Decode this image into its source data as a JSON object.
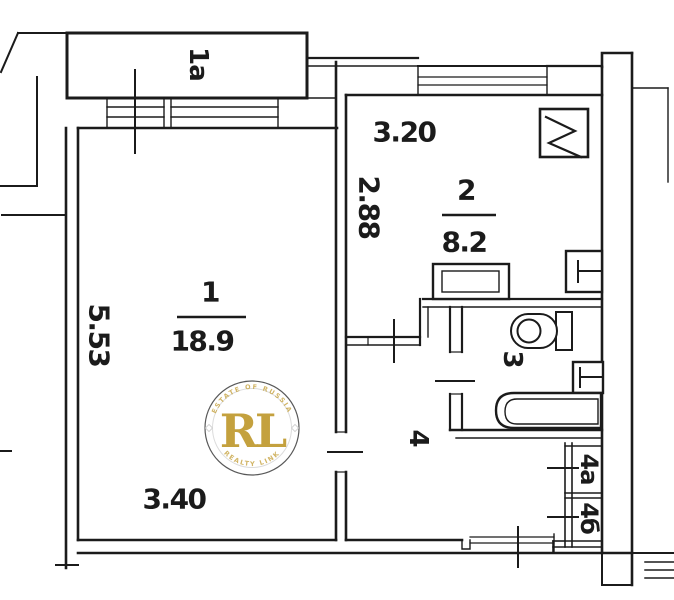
{
  "rooms": {
    "balcony_label": "1a",
    "room1": {
      "number": "1",
      "area": "18.9",
      "width": "3.40",
      "height": "5.53"
    },
    "room2": {
      "number": "2",
      "area": "8.2",
      "width": "3.20",
      "height": "2.88"
    },
    "room3": {
      "number": "3"
    },
    "hall": {
      "number": "4"
    },
    "closet_a": {
      "number": "4a"
    },
    "closet_b": {
      "number": "4б"
    }
  },
  "fixtures": [
    "sink",
    "stove",
    "basin-kitchen",
    "toilet",
    "basin-bath",
    "bathtub"
  ],
  "watermark": {
    "monogram": "RL",
    "arc_top": "ESTATE OF RUSSIA",
    "arc_bottom": "REALTY LINK",
    "gold": "#c09a2e"
  },
  "colors": {
    "ink": "#1b1b1b",
    "background": "#ffffff"
  }
}
